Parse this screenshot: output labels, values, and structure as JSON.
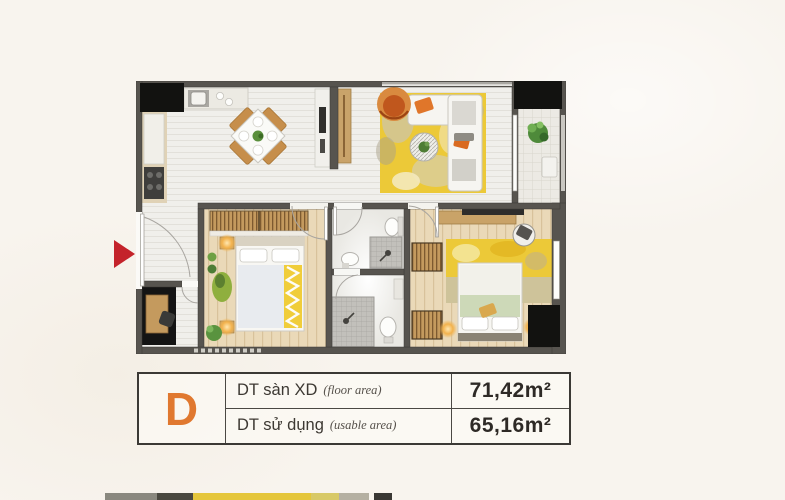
{
  "page": {
    "background": "#f8f4ee"
  },
  "colors": {
    "accent": "#e0782f",
    "arrow": "#c4232b",
    "wall": "#57544f",
    "shaft": "#121210",
    "rug_yellow": "#ecc938",
    "wood_floor": "#ead9b8",
    "glow": "#f2b24d"
  },
  "marker": {
    "type": "entrance-arrow"
  },
  "info_table": {
    "unit_label": "D",
    "rows": [
      {
        "label": "DT sàn XD",
        "label_en": "(floor area)",
        "value": "71,42m²"
      },
      {
        "label": "DT sử dụng",
        "label_en": "(usable area)",
        "value": "65,16m²"
      }
    ]
  },
  "next_image_strip": {
    "segments": [
      {
        "x": 105,
        "w": 52,
        "color": "#8a887f"
      },
      {
        "x": 157,
        "w": 36,
        "color": "#4a4840"
      },
      {
        "x": 193,
        "w": 118,
        "color": "#e5c63b"
      },
      {
        "x": 311,
        "w": 28,
        "color": "#d8c967"
      },
      {
        "x": 339,
        "w": 30,
        "color": "#b5b0a2"
      },
      {
        "x": 374,
        "w": 18,
        "color": "#3a3834"
      }
    ]
  }
}
